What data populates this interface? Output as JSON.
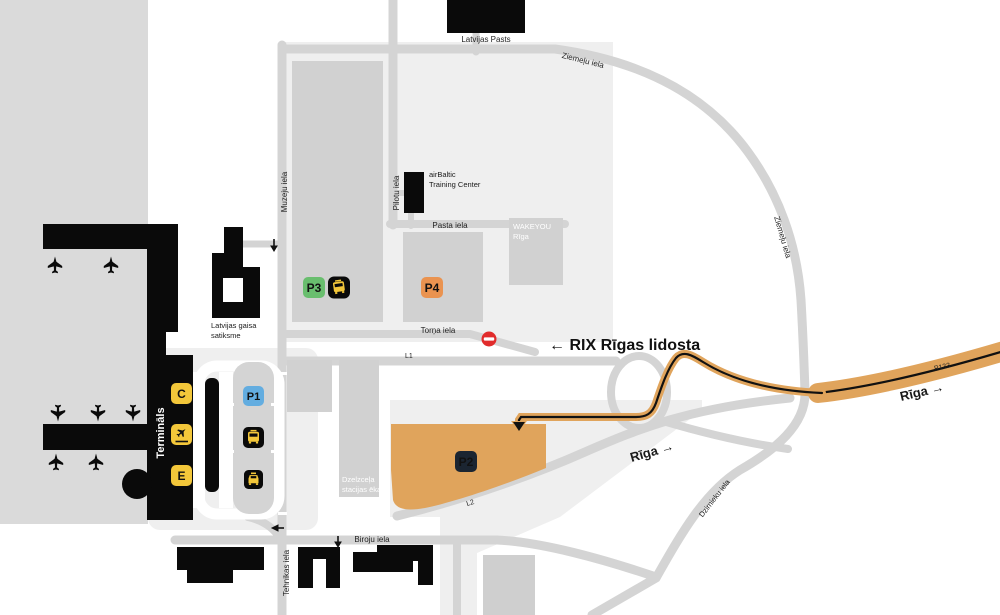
{
  "map_name": "RIX Riga Airport area map",
  "labels": {
    "latvijas_pasts": "Latvijas Pasts",
    "ziemelu_iela_top": "Ziemeļu iela",
    "ziemelu_iela_right": "Ziemeļu iela",
    "muzeju_iela": "Muzeju iela",
    "pilotu_iela": "Pilotu iela",
    "pasta_iela": "Pasta iela",
    "airbaltic_line1": "airBaltic",
    "airbaltic_line2": "Training Center",
    "wakeyou_line1": "WAKEYOU",
    "wakeyou_line2": "Rīga",
    "torna_iela": "Torņa iela",
    "rix_direction": "← RIX Rīgas lidosta",
    "l1": "L1",
    "l2": "L2",
    "latvijas_gaisa_line1": "Latvijas gaisa",
    "latvijas_gaisa_line2": "satiksme",
    "terminals": "Termināls",
    "dzelzcela_line1": "Dzelzceļa",
    "dzelzcela_line2": "stacijas ēka",
    "biroju_iela": "Biroju iela",
    "tehnikas_iela": "Tehnikas iela",
    "riga_mid": "Rīga →",
    "riga_right": "Rīga →",
    "p133": "P133",
    "dzirnieku_iela": "Dzirnieku iela"
  },
  "badges": {
    "p1": "P1",
    "p2": "P2",
    "p3": "P3",
    "p4": "P4",
    "gate_c": "C",
    "gate_e": "E"
  },
  "icons": {
    "bus": "bus-front-glyph",
    "taxi": "taxi-front-glyph",
    "departures": "plane-departure-glyph",
    "no_entry": "no-entry-sign",
    "plane": "aircraft-stand-glyph",
    "route_arrow": "driving-route-arrow"
  },
  "colors": {
    "badge_yellow": "#f3c73a",
    "p1_blue": "#63ade0",
    "p2_orange": "#e0a45c",
    "p3_green": "#69be6e",
    "p4_orange": "#ea9350",
    "badge_dark": "#1b2531",
    "route_orange": "#e0a45c",
    "no_entry_red": "#e12c2c",
    "building_black": "#0a0a0a"
  }
}
